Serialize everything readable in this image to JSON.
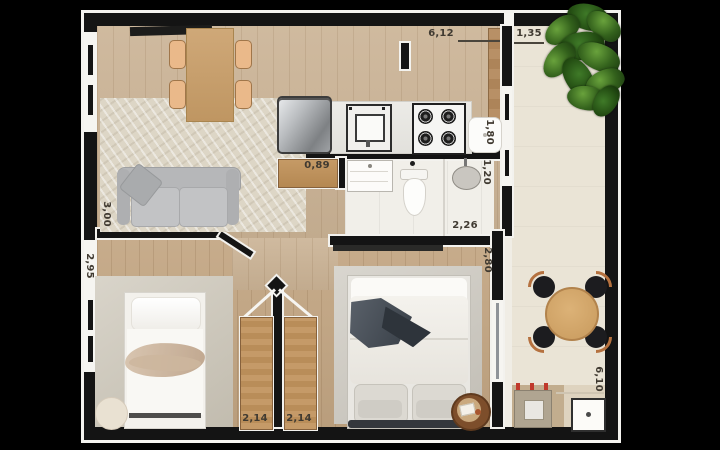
{
  "meta": {
    "type": "apartment-floor-plan",
    "background": "#000000"
  },
  "dimensions": {
    "kitchen_width": "6,12",
    "balcony_width": "1,35",
    "hall_width": "0,89",
    "kitchen_window": "1,80",
    "bathroom_width": "1,20",
    "bathroom_length": "2,26",
    "bedroom2_depth": "2,80",
    "living_left": "3,00",
    "bedroom1_left": "2,95",
    "bedroom1_door": "2,14",
    "bedroom2_door": "2,14",
    "balcony_length": "6,10"
  },
  "colors": {
    "wall": "#141414",
    "outline": "#f3f2ee",
    "living_wood": "#cab294",
    "bedroom_wood": "#c3a683",
    "bathroom_tile": "#f1efe9",
    "balcony_tile": "#eae4d6",
    "door_wood": "#c59a68",
    "plant_green": "#33611c",
    "label_text": "#403a31"
  },
  "furniture": [
    "sideboard",
    "dining-table",
    "dining-chair",
    "sofa",
    "area-rug",
    "refrigerator",
    "kitchen-counter",
    "kitchen-sink",
    "stove",
    "kitchen-appliance",
    "tall-cabinet",
    "bathroom-vanity",
    "toilet",
    "shower-basin",
    "single-bed",
    "pouf",
    "double-bed",
    "bedside-table",
    "bedroom-door",
    "patio-table",
    "patio-chair",
    "potted-plant",
    "washing-machine",
    "laundry-sink"
  ]
}
